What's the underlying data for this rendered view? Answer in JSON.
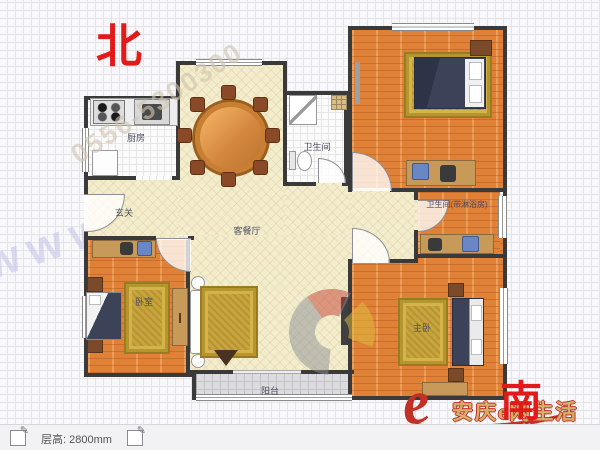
{
  "compass": {
    "north": "北",
    "south": "南"
  },
  "rooms": {
    "kitchen": "厨房",
    "bathroom": "卫生间",
    "entrance": "玄关",
    "living_dining": "客餐厅",
    "bedroom_left": "卧室",
    "bedroom_master": "主卧",
    "bath_master": "卫生间(带淋浴房)",
    "balcony": "阳台"
  },
  "watermarks": {
    "phone": "0556-5300300",
    "site": "www.house.net",
    "brand_cn": "安庆e网生活",
    "brand_url": "www.aqlife.com",
    "logo_letter": "e"
  },
  "statusbar": {
    "floor_height": "层高: 2800mm",
    "edit_icon": "✎"
  },
  "colors": {
    "compass-red": "#e21a1a",
    "wall": "#3a3a3a",
    "floor-wood": "#e08138",
    "floor-cream": "#f3edcd",
    "floor-tile": "#fbfbfb",
    "floor-balcony": "#dcdcde",
    "rug-gold": "#c8a43c",
    "bed-navy": "#3c4257",
    "brand-red": "#c23026"
  }
}
